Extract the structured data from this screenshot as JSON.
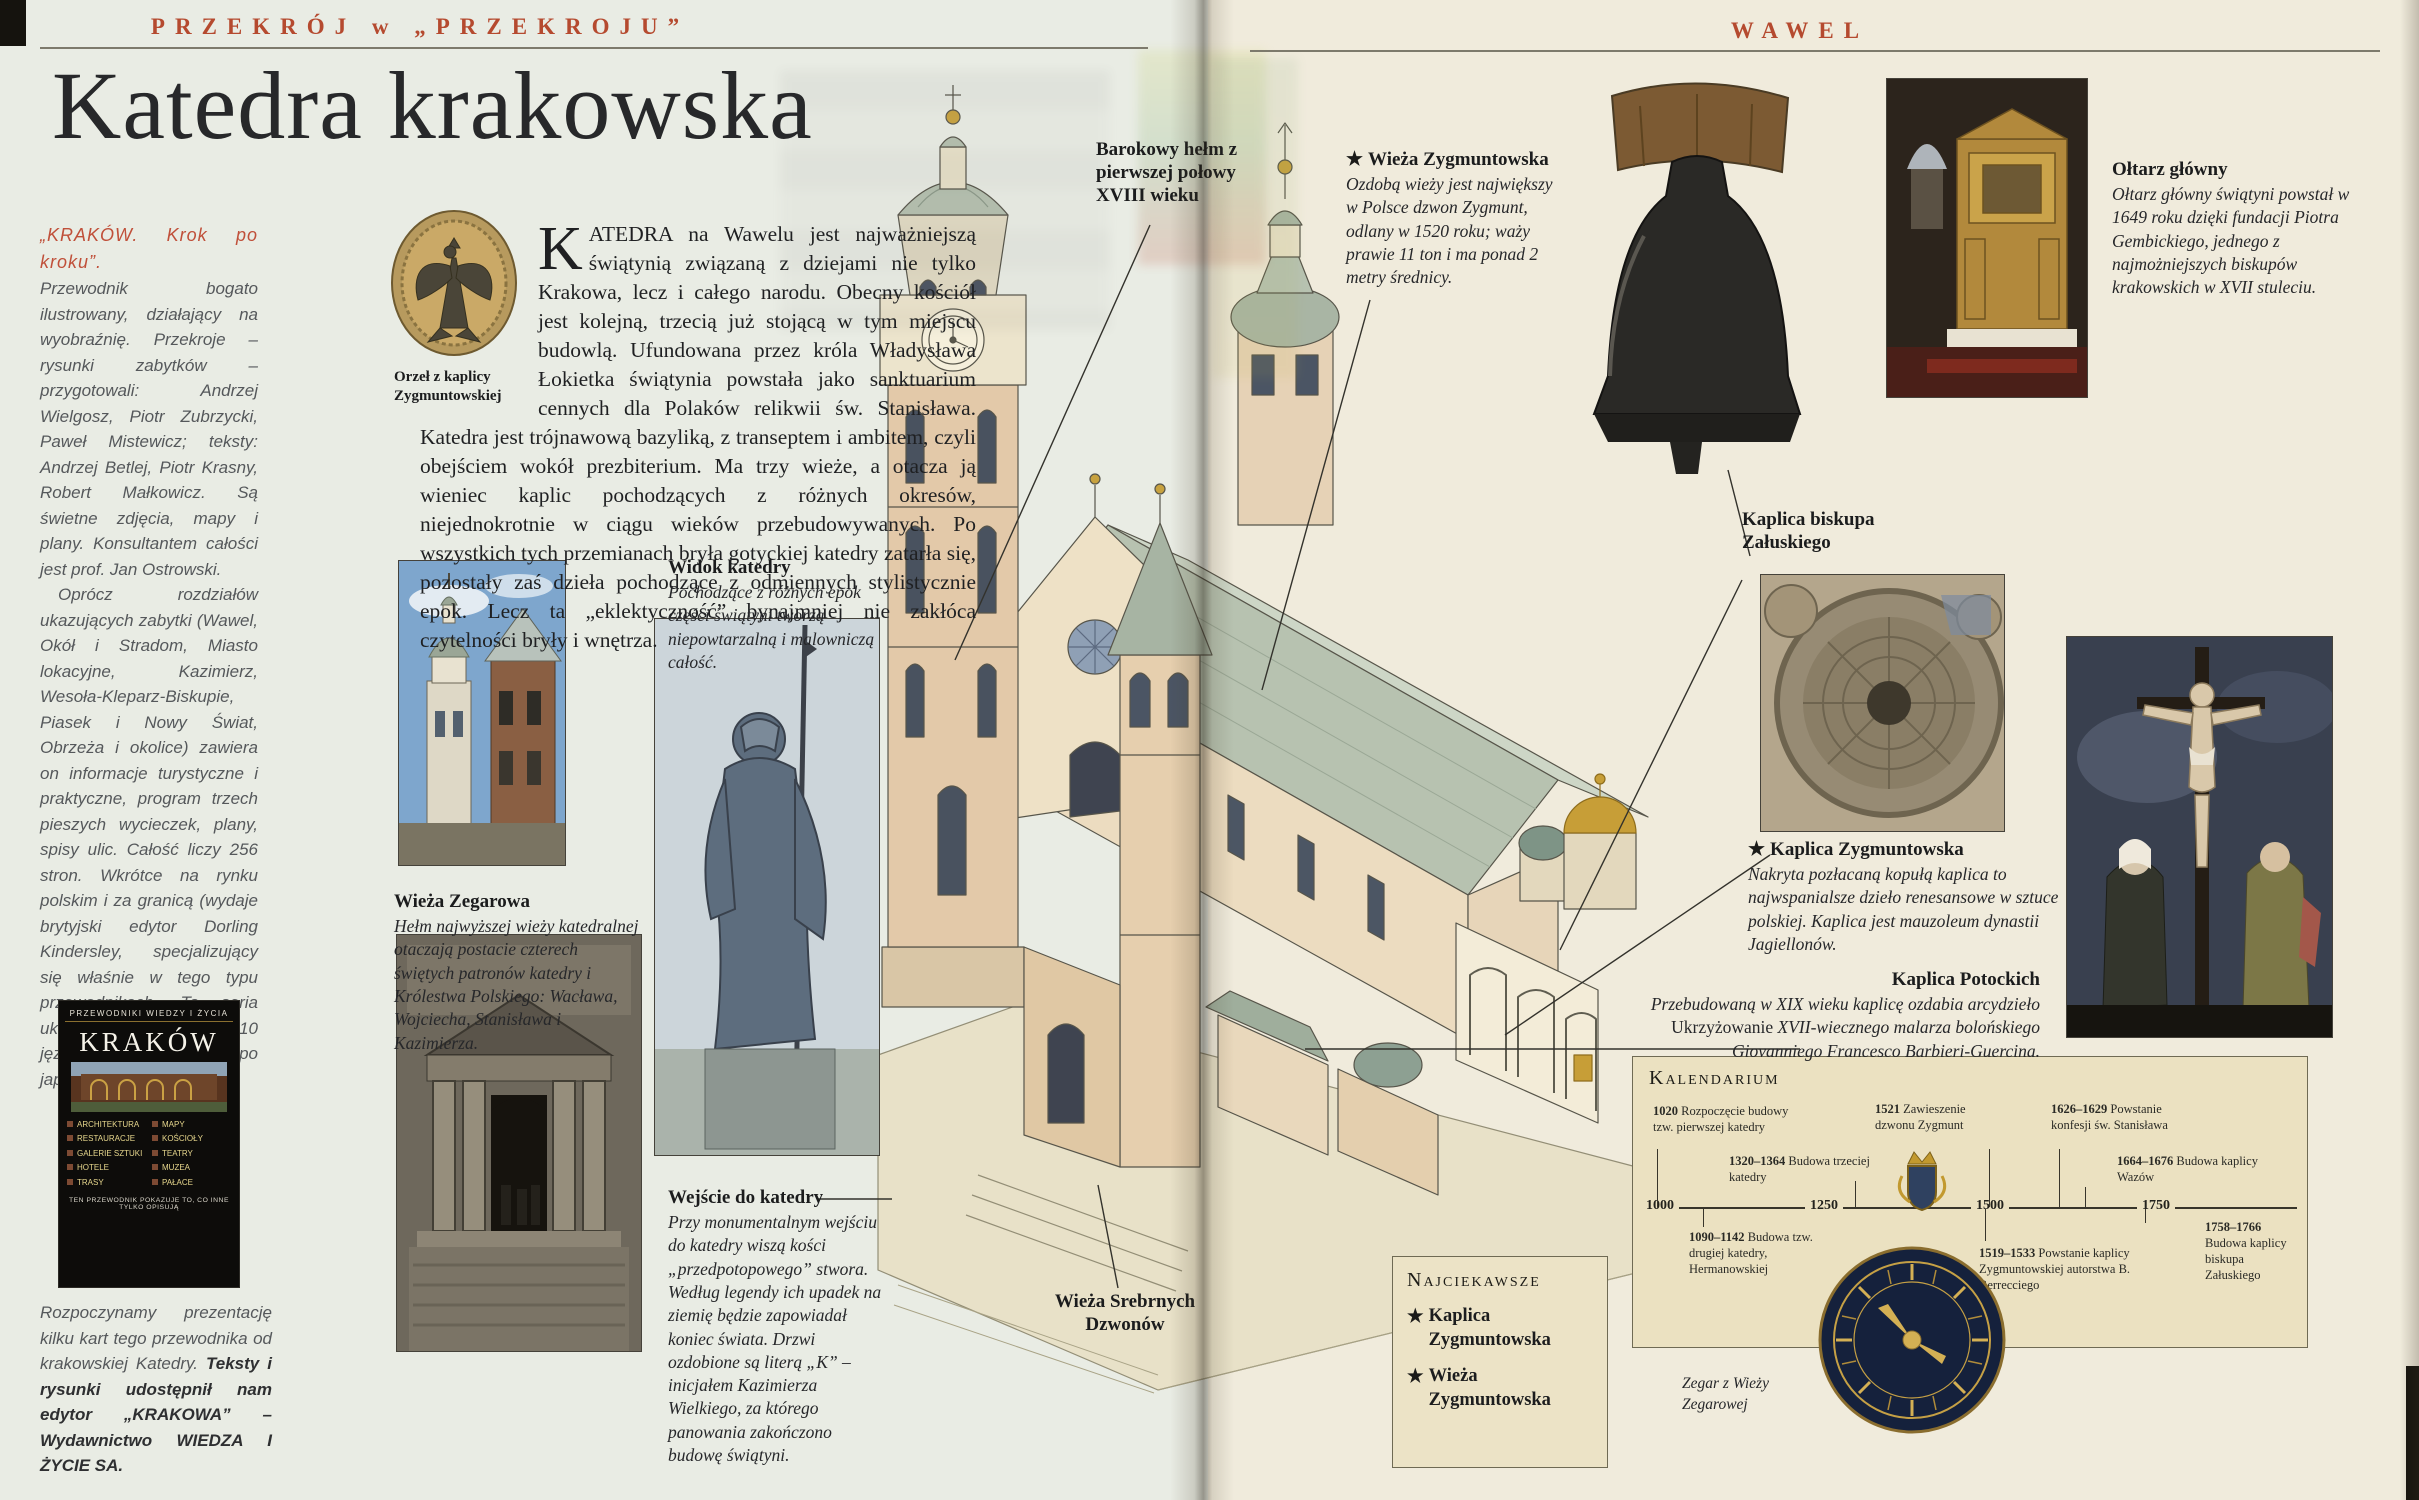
{
  "star_glyph": "★",
  "left": {
    "header": "PRZEKRÓJ w „PRZEKROJU”",
    "title": "Katedra krakowska",
    "column": {
      "lead": "„KRAKÓW. Krok po kroku”.",
      "para1": "Przewodnik bogato ilustrowany, działający na wyobraźnię. Przekroje – rysunki zabytków – przygotowali: Andrzej Wielgosz, Piotr Zubrzycki, Paweł Mistewicz; teksty: Andrzej Betlej, Piotr Krasny, Robert Małkowicz. Są świetne zdjęcia, mapy i plany. Konsultantem całości jest prof. Jan Ostrowski.",
      "para2": "Oprócz rozdziałów ukazujących zabytki (Wawel, Okół i Stradom, Miasto lokacyjne, Kazimierz, Wesoła-Kleparz-Biskupie, Piasek i Nowy Świat, Obrzeża i okolice) zawiera on informacje turystyczne i praktyczne, program trzech pieszych wycieczek, plany, spisy ulic. Całość liczy 256 stron. Wkrótce na rynku polskim i za granicą (wydaje brytyjski edytor Dorling Kindersley, specjalizujący się właśnie w tego typu przewodnikach. Ta seria ukazuje się w 14 krajach i 10 językach, w tym po japońsku).",
      "footer_plain": "Rozpoczynamy prezentację kilku kart tego przewodnika od krakowskiej Katedry. ",
      "footer_bold": "Teksty i rysunki udostępnił nam edytor „KRAKOWA” – Wydawnictwo WIEDZA I ŻYCIE SA."
    },
    "book": {
      "series": "PRZEWODNIKI WIEDZY I ŻYCIA",
      "title": "KRAKÓW",
      "topics": [
        "ARCHITEKTURA",
        "RESTAURACJE",
        "GALERIE SZTUKI",
        "HOTELE",
        "TRASY",
        "MAPY",
        "KOŚCIOŁY",
        "TEATRY",
        "MUZEA",
        "PAŁACE"
      ],
      "slogan": "TEN PRZEWODNIK POKAZUJE TO, CO INNE TYLKO OPISUJĄ"
    },
    "medallion_caption": "Orzeł z kaplicy Zygmuntowskiej",
    "intro_dropcap": "K",
    "intro_text": "ATEDRA na Wawelu jest najważniejszą świątynią związaną z dziejami nie tylko Krakowa, lecz i całego narodu. Obecny kościół jest kolejną, trzecią już stojącą w tym miejscu budowlą. Ufundowana przez króla Władysława Łokietka świątynia powstała jako sanktuarium cennych dla Polaków relikwii św. Stanisława. Katedra jest trójnawową bazyliką, z transeptem i ambitem, czyli obejściem wokół prezbiterium. Ma trzy wieże, a otacza ją wieniec kaplic pochodzących z różnych okresów, niejednokrotnie w ciągu wieków przebudowywanych. Po wszystkich tych przemianach bryła gotyckiej katedry zatarła się, pozostały zaś dzieła pochodzące z odmiennych stylistycznie epok. Lecz ta „eklektyczność” bynajmniej nie zakłóca czytelności bryły i wnętrza.",
    "widok_title": "Widok katedry",
    "widok_text": "Pochodzące z różnych epok części świątyni tworzą niepowtarzalną i malowniczą całość.",
    "zegarowa_title": "Wieża Zegarowa",
    "zegarowa_text": "Hełm najwyższej wieży katedralnej otaczają postacie czterech świętych patronów katedry i Królestwa Polskiego: Wacława, Wojciecha, Stanisława i Kazimierza.",
    "wejscie_title": "Wejście do katedry",
    "wejscie_text": "Przy monumentalnym wejściu do katedry wiszą kości „przedpotopowego” stwora. Według legendy ich upadek na ziemię będzie zapowiadał koniec świata. Drzwi ozdobione są literą „K” – inicjałem Kazimierza Wielkiego, za którego panowania zakończono budowę świątyni.",
    "barokowy_caption": "Barokowy hełm z pierwszej połowy XVIII wieku"
  },
  "right": {
    "header": "WAWEL",
    "dzwon_title": "Wieża Zygmuntowska",
    "dzwon_text": "Ozdobą wieży jest największy w Polsce dzwon Zygmunt, odlany w 1520 roku; waży prawie 11 ton i ma ponad 2 metry średnicy.",
    "oltarz_title": "Ołtarz główny",
    "oltarz_text": "Ołtarz główny świątyni powstał w 1649 roku dzięki fundacji Piotra Gembickiego, jednego z najmożniejszych biskupów krakowskich w XVII stuleciu.",
    "zaluski_caption": "Kaplica biskupa Załuskiego",
    "zygmuntowska_title": "Kaplica Zygmuntowska",
    "zygmuntowska_text": "Nakryta pozłacaną kopułą kaplica to najwspanialsze dzieło renesansowe w sztuce polskiej. Kaplica jest mauzoleum dynastii Jagiellonów.",
    "potockich_title": "Kaplica Potockich",
    "potockich_pre": "Przebudowaną w XIX wieku kaplicę ozdabia arcydzieło ",
    "potockich_em": "Ukrzyżowanie",
    "potockich_post": " XVII-wiecznego malarza bolońskiego Giovanniego Francesco Barbieri-Guercina.",
    "srebrnych_caption": "Wieża Srebrnych Dzwonów",
    "zegar_caption": "Zegar z Wieży Zegarowej",
    "kalendarium": {
      "title": "Kalendarium",
      "axis": [
        "1000",
        "1250",
        "1500",
        "1750"
      ],
      "above": [
        {
          "y": "1020",
          "t": " Rozpoczęcie budowy tzw. pierwszej katedry"
        },
        {
          "y": "1320–1364",
          "t": " Budowa trzeciej katedry"
        },
        {
          "y": "1521",
          "t": " Zawieszenie dzwonu Zygmunt"
        },
        {
          "y": "1626–1629",
          "t": " Powstanie konfesji św. Stanisława"
        },
        {
          "y": "1664–1676",
          "t": " Budowa kaplicy Wazów"
        }
      ],
      "below": [
        {
          "y": "1090–1142",
          "t": " Budowa tzw. drugiej katedry, Hermanowskiej"
        },
        {
          "y": "1519–1533",
          "t": " Powstanie kaplicy Zygmuntowskiej autorstwa B. Berrecciego"
        },
        {
          "y": "1758–1766",
          "t": " Budowa kaplicy biskupa Załuskiego"
        }
      ]
    },
    "najciekawsze": {
      "title": "Najciekawsze",
      "items": [
        "Kaplica Zygmuntowska",
        "Wieża Zygmuntowska"
      ]
    }
  }
}
